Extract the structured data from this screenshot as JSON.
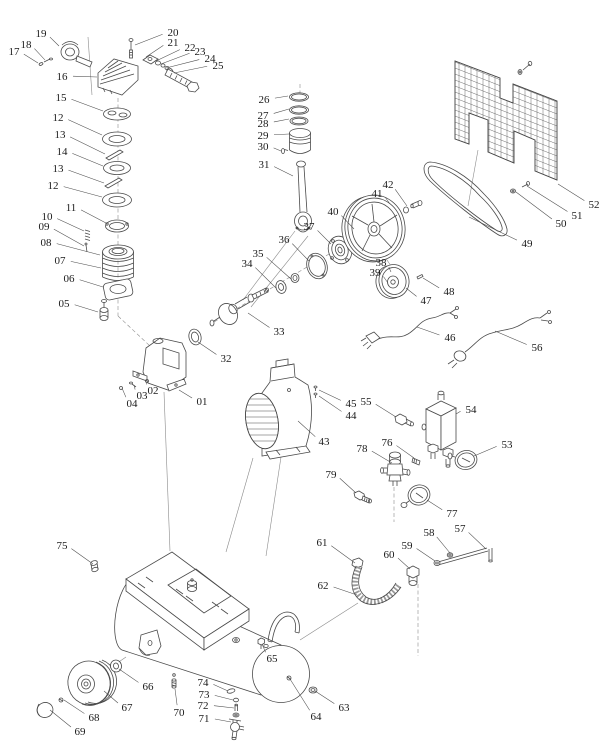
{
  "canvas": {
    "width": 615,
    "height": 755
  },
  "figure": {
    "background_color": "#ffffff",
    "line_color": "#4a4a4a",
    "construction_line_color": "#8a8a8a",
    "label_color": "#1b1b1b"
  },
  "parts": [
    {
      "label": "17",
      "x": 14,
      "y": 51,
      "tx": 38,
      "ty": 63
    },
    {
      "label": "18",
      "x": 26,
      "y": 44,
      "tx": 45,
      "ty": 60
    },
    {
      "label": "19",
      "x": 41,
      "y": 33,
      "tx": 59,
      "ty": 46
    },
    {
      "label": "16",
      "x": 62,
      "y": 76,
      "tx": 97,
      "ty": 77
    },
    {
      "label": "15",
      "x": 61,
      "y": 97,
      "tx": 103,
      "ty": 111
    },
    {
      "label": "12",
      "x": 58,
      "y": 117,
      "tx": 102,
      "ty": 135
    },
    {
      "label": "13",
      "x": 60,
      "y": 134,
      "tx": 105,
      "ty": 154
    },
    {
      "label": "14",
      "x": 62,
      "y": 151,
      "tx": 103,
      "ty": 166
    },
    {
      "label": "13",
      "x": 58,
      "y": 168,
      "tx": 104,
      "ty": 183
    },
    {
      "label": "12",
      "x": 53,
      "y": 185,
      "tx": 102,
      "ty": 197
    },
    {
      "label": "11",
      "x": 71,
      "y": 207,
      "tx": 106,
      "ty": 223
    },
    {
      "label": "10",
      "x": 47,
      "y": 216,
      "tx": 84,
      "ty": 231
    },
    {
      "label": "09",
      "x": 44,
      "y": 226,
      "tx": 84,
      "ty": 246
    },
    {
      "label": "08",
      "x": 46,
      "y": 242,
      "tx": 100,
      "ty": 255
    },
    {
      "label": "07",
      "x": 60,
      "y": 260,
      "tx": 101,
      "ty": 268
    },
    {
      "label": "06",
      "x": 69,
      "y": 278,
      "tx": 103,
      "ty": 287
    },
    {
      "label": "05",
      "x": 64,
      "y": 303,
      "tx": 98,
      "ty": 312
    },
    {
      "label": "20",
      "x": 173,
      "y": 32,
      "tx": 135,
      "ty": 45
    },
    {
      "label": "21",
      "x": 173,
      "y": 42,
      "tx": 146,
      "ty": 57
    },
    {
      "label": "22",
      "x": 190,
      "y": 47,
      "tx": 156,
      "ty": 61
    },
    {
      "label": "23",
      "x": 200,
      "y": 51,
      "tx": 161,
      "ty": 64
    },
    {
      "label": "24",
      "x": 210,
      "y": 58,
      "tx": 166,
      "ty": 68
    },
    {
      "label": "25",
      "x": 218,
      "y": 65,
      "tx": 174,
      "ty": 73
    },
    {
      "label": "26",
      "x": 264,
      "y": 99,
      "tx": 288,
      "ty": 96
    },
    {
      "label": "27",
      "x": 263,
      "y": 115,
      "tx": 289,
      "ty": 109
    },
    {
      "label": "28",
      "x": 263,
      "y": 123,
      "tx": 289,
      "ty": 119
    },
    {
      "label": "29",
      "x": 263,
      "y": 135,
      "tx": 289,
      "ty": 134
    },
    {
      "label": "30",
      "x": 263,
      "y": 146,
      "tx": 281,
      "ty": 151
    },
    {
      "label": "31",
      "x": 264,
      "y": 164,
      "tx": 293,
      "ty": 176
    },
    {
      "label": "32",
      "x": 226,
      "y": 358,
      "tx": 198,
      "ty": 342
    },
    {
      "label": "33",
      "x": 279,
      "y": 331,
      "tx": 248,
      "ty": 313
    },
    {
      "label": "34",
      "x": 247,
      "y": 263,
      "tx": 276,
      "ty": 288
    },
    {
      "label": "35",
      "x": 258,
      "y": 253,
      "tx": 291,
      "ty": 279
    },
    {
      "label": "36",
      "x": 284,
      "y": 239,
      "tx": 309,
      "ty": 261
    },
    {
      "label": "37",
      "x": 309,
      "y": 226,
      "tx": 331,
      "ty": 244
    },
    {
      "label": "40",
      "x": 333,
      "y": 211,
      "tx": 354,
      "ty": 229
    },
    {
      "label": "41",
      "x": 377,
      "y": 193,
      "tx": 390,
      "ty": 204
    },
    {
      "label": "42",
      "x": 388,
      "y": 184,
      "tx": 407,
      "ty": 206
    },
    {
      "label": "38",
      "x": 381,
      "y": 262,
      "tx": 391,
      "ty": 272
    },
    {
      "label": "39",
      "x": 375,
      "y": 272,
      "tx": 388,
      "ty": 283
    },
    {
      "label": "47",
      "x": 426,
      "y": 300,
      "tx": 406,
      "ty": 288
    },
    {
      "label": "48",
      "x": 449,
      "y": 291,
      "tx": 423,
      "ty": 278
    },
    {
      "label": "49",
      "x": 527,
      "y": 243,
      "tx": 469,
      "ty": 217
    },
    {
      "label": "50",
      "x": 561,
      "y": 223,
      "tx": 516,
      "ty": 192
    },
    {
      "label": "51",
      "x": 577,
      "y": 215,
      "tx": 527,
      "ty": 186
    },
    {
      "label": "52",
      "x": 594,
      "y": 204,
      "tx": 558,
      "ty": 184
    },
    {
      "label": "46",
      "x": 450,
      "y": 337,
      "tx": 417,
      "ty": 327
    },
    {
      "label": "56",
      "x": 537,
      "y": 347,
      "tx": 495,
      "ty": 331
    },
    {
      "label": "43",
      "x": 324,
      "y": 441,
      "tx": 298,
      "ty": 421
    },
    {
      "label": "45",
      "x": 351,
      "y": 403,
      "tx": 319,
      "ty": 390
    },
    {
      "label": "44",
      "x": 351,
      "y": 415,
      "tx": 319,
      "ty": 396
    },
    {
      "label": "55",
      "x": 366,
      "y": 401,
      "tx": 396,
      "ty": 417
    },
    {
      "label": "54",
      "x": 471,
      "y": 409,
      "tx": 456,
      "ty": 414
    },
    {
      "label": "76",
      "x": 387,
      "y": 442,
      "tx": 414,
      "ty": 458
    },
    {
      "label": "78",
      "x": 362,
      "y": 448,
      "tx": 392,
      "ty": 463
    },
    {
      "label": "79",
      "x": 331,
      "y": 474,
      "tx": 356,
      "ty": 493
    },
    {
      "label": "77",
      "x": 452,
      "y": 513,
      "tx": 427,
      "ty": 500
    },
    {
      "label": "53",
      "x": 507,
      "y": 444,
      "tx": 474,
      "ty": 456
    },
    {
      "label": "57",
      "x": 460,
      "y": 528,
      "tx": 486,
      "ty": 549
    },
    {
      "label": "58",
      "x": 429,
      "y": 532,
      "tx": 450,
      "ty": 553
    },
    {
      "label": "59",
      "x": 407,
      "y": 545,
      "tx": 435,
      "ty": 561
    },
    {
      "label": "60",
      "x": 389,
      "y": 554,
      "tx": 410,
      "ty": 569
    },
    {
      "label": "61",
      "x": 322,
      "y": 542,
      "tx": 355,
      "ty": 563
    },
    {
      "label": "62",
      "x": 323,
      "y": 585,
      "tx": 357,
      "ty": 595
    },
    {
      "label": "75",
      "x": 62,
      "y": 545,
      "tx": 93,
      "ty": 564
    },
    {
      "label": "65",
      "x": 272,
      "y": 658,
      "tx": 262,
      "ty": 644
    },
    {
      "label": "63",
      "x": 344,
      "y": 707,
      "tx": 315,
      "ty": 691
    },
    {
      "label": "64",
      "x": 316,
      "y": 716,
      "tx": 290,
      "ty": 679
    },
    {
      "label": "66",
      "x": 148,
      "y": 686,
      "tx": 119,
      "ty": 669
    },
    {
      "label": "67",
      "x": 127,
      "y": 707,
      "tx": 104,
      "ty": 691
    },
    {
      "label": "68",
      "x": 94,
      "y": 717,
      "tx": 64,
      "ty": 700
    },
    {
      "label": "69",
      "x": 80,
      "y": 731,
      "tx": 50,
      "ty": 710
    },
    {
      "label": "70",
      "x": 179,
      "y": 712,
      "tx": 175,
      "ty": 689
    },
    {
      "label": "74",
      "x": 203,
      "y": 682,
      "tx": 228,
      "ty": 691
    },
    {
      "label": "73",
      "x": 204,
      "y": 694,
      "tx": 233,
      "ty": 700
    },
    {
      "label": "72",
      "x": 203,
      "y": 705,
      "tx": 234,
      "ty": 708
    },
    {
      "label": "71",
      "x": 204,
      "y": 718,
      "tx": 231,
      "ty": 722
    },
    {
      "label": "01",
      "x": 202,
      "y": 401,
      "tx": 179,
      "ty": 390
    },
    {
      "label": "02",
      "x": 153,
      "y": 390,
      "tx": 147,
      "ty": 382
    },
    {
      "label": "03",
      "x": 142,
      "y": 395,
      "tx": 134,
      "ty": 385
    },
    {
      "label": "04",
      "x": 132,
      "y": 403,
      "tx": 122,
      "ty": 388
    }
  ]
}
